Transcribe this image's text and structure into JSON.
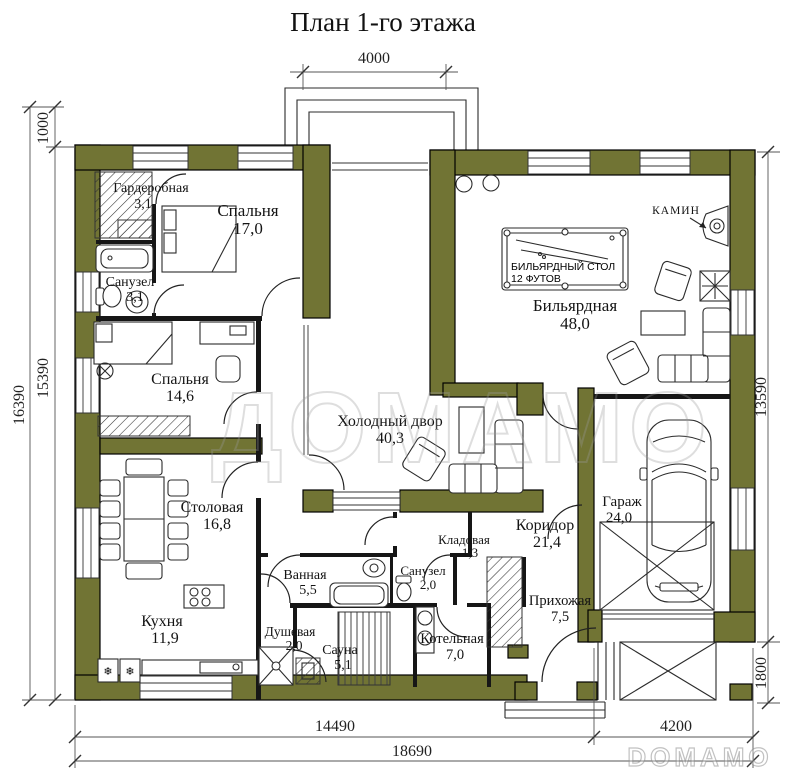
{
  "title": "План 1-го этажа",
  "watermarks": {
    "center": "ДОМАМО",
    "corner": "DOMAMO"
  },
  "colors": {
    "wall": "#717434",
    "line": "#161616"
  },
  "symbols": {
    "fridge": "❄"
  },
  "dimensions": {
    "top": "4000",
    "left": {
      "total": "16390",
      "upper": "1000",
      "lower": "15390"
    },
    "right": {
      "upper": "13590",
      "lower": "1800"
    },
    "bottom": {
      "left": "14490",
      "right": "4200",
      "total": "18690"
    }
  },
  "annotations": {
    "fireplace": "КАМИН",
    "billiard_line1": "БИЛЬЯРДНЫЙ СТОЛ",
    "billiard_line2": "12 ФУТОВ"
  },
  "rooms": [
    {
      "name": "Гардеробная",
      "area": "3,1"
    },
    {
      "name": "Спальня",
      "area": "17,0"
    },
    {
      "name": "Санузел",
      "area": "3,1"
    },
    {
      "name": "Спальня",
      "area": "14,6"
    },
    {
      "name": "Бильярдная",
      "area": "48,0"
    },
    {
      "name": "Холодный двор",
      "area": "40,3"
    },
    {
      "name": "Столовая",
      "area": "16,8"
    },
    {
      "name": "Кухня",
      "area": "11,9"
    },
    {
      "name": "Ванная",
      "area": "5,5"
    },
    {
      "name": "Санузел",
      "area": "2,0"
    },
    {
      "name": "Кладовая",
      "area": "1,3"
    },
    {
      "name": "Коридор",
      "area": "21,4"
    },
    {
      "name": "Душевая",
      "area": "2,0"
    },
    {
      "name": "Сауна",
      "area": "5,1"
    },
    {
      "name": "Котельная",
      "area": "7,0"
    },
    {
      "name": "Прихожая",
      "area": "7,5"
    },
    {
      "name": "Гараж",
      "area": "24,0"
    }
  ]
}
